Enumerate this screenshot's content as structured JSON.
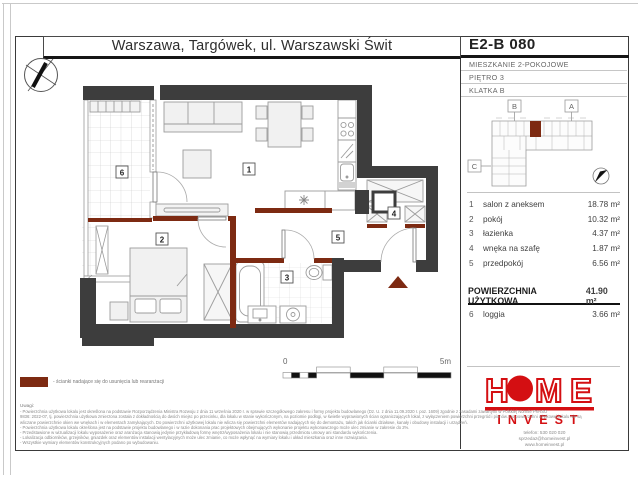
{
  "header": {
    "title": "Warszawa, Targówek, ul. Warszawski Świt",
    "unit_id": "E2-B 080",
    "details": [
      "MIESZKANIE 2-POKOJOWE",
      "PIĘTRO 3",
      "KLATKA B"
    ]
  },
  "locator": {
    "section_b": "B",
    "section_a": "A",
    "section_c": "C"
  },
  "rooms": [
    {
      "no": "1",
      "name": "salon z aneksem",
      "area": "18.78 m²"
    },
    {
      "no": "2",
      "name": "pokój",
      "area": "10.32 m²"
    },
    {
      "no": "3",
      "name": "łazienka",
      "area": "4.37 m²"
    },
    {
      "no": "4",
      "name": "wnęka na szafę",
      "area": "1.87 m²"
    },
    {
      "no": "5",
      "name": "przedpokój",
      "area": "6.56 m²"
    }
  ],
  "summary": {
    "label": "POWIERZCHNIA UŻYTKOWA",
    "value": "41.90 m²"
  },
  "extra_room": {
    "no": "6",
    "name": "loggia",
    "value": "3.66 m²"
  },
  "plan": {
    "labels": {
      "salon": "1",
      "pokoj": "2",
      "lazienka": "3",
      "wneka": "4",
      "przedpokoj": "5",
      "loggia": "6"
    }
  },
  "scale_bar": {
    "start": "0",
    "end": "5m"
  },
  "legend": {
    "text": "- ścianki nadające się do usunięcia lub rearanżacji",
    "color": "#7d2a12"
  },
  "notes": {
    "heading": "Uwagi:",
    "lines": [
      "- Powierzchnia użytkowa lokalu jest określona na podstawie Rozporządzenia Ministra Rozwoju z dnia 11 września 2020 r. w sprawie szczegółowego zakresu i formy projektu budowlanego (Dz. U. z dnia 11.09.2020 r. poz. 1609) zgodnie z zasadami zawartymi w Polskiej Normie PN-ISO",
      "9836: 2022-07, tj. powierzchnia użytkowa zmierzona została z dokładnością do dwóch miejsc po przecinku, dla lokalu w stanie wykończonym, na poziomie podłogi, w świetle wyprawionych ścian ograniczających lokal, z wyłączeniem powierzchni przegród i pionów. Do powierzchni użytkowej lokalu nie są",
      "wliczane powierzchnie okien we wnękach i w elementach zamykających. Do powierzchni użytkowej lokalu nie wlicza się powierzchni elementów nadających się do demontażu, takich jak ścianki działowe, kanały i obudowy instalacji i urządzeń.",
      "- Powierzchnia użytkowa lokalu określona jest na podstawie projektu budowlanego i w razie dokonania prac projektowych obejmujących wykonanie projektu wykonawczego może ulec zmianie w zakresie do 2%.",
      "- Przedstawione w wizualizacji lokalu wyposażenie oraz aranżacja stanowią jedynie przykładową formę wnętrz/wyposażenia lokalu i nie stanowią przedmiotu umowy ani standardu wykończenia.",
      "- Lokalizacja odbiorników, grzejników, gniazdek oraz elementów instalacji wentylacyjnych może ulec zmianie, co może wpłynąć na wymiary lokalu i układ mieszkania oraz inne rozwiązania.",
      "- Wszystkie wymiary elementów konstrukcyjnych podano po wybudowaniu."
    ]
  },
  "logo": {
    "h": "H",
    "m": "M",
    "e": "E",
    "invest": "INVEST",
    "phone": "telefon: 530 020 020",
    "email": "sprzedaz@homeinvest.pl",
    "website": "www.homeinvest.pl"
  },
  "colors": {
    "wall": "#3d3d3d",
    "removable_wall": "#7d2a12",
    "logo_red": "#d40f12"
  }
}
